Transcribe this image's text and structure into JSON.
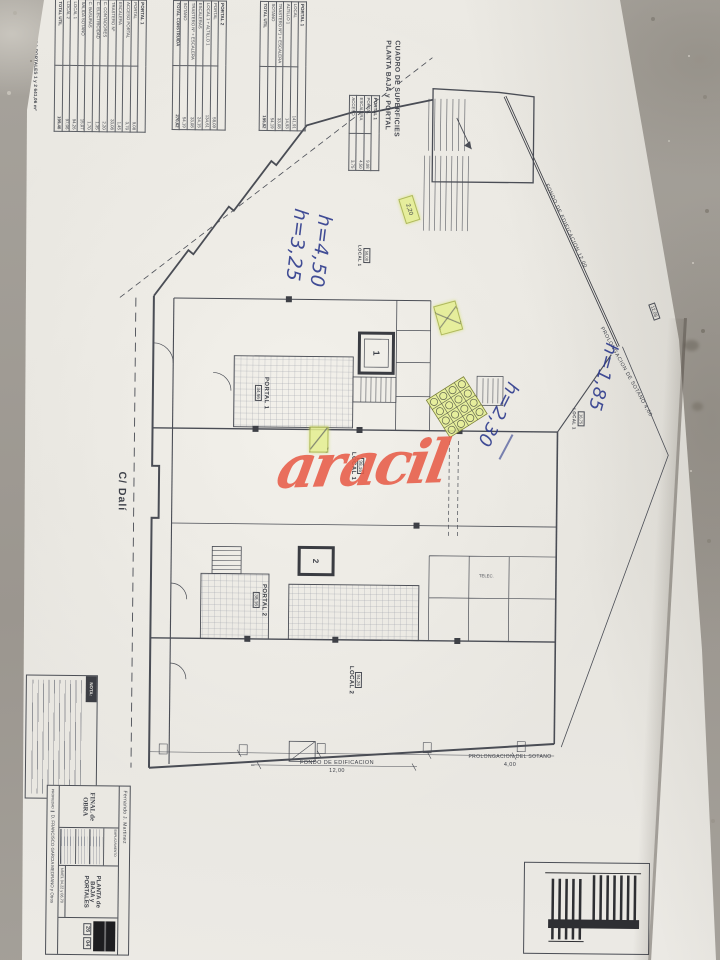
{
  "photo": {
    "street_label": "C/ Dalí",
    "watermark_text": "aracil",
    "watermark_color": "#e75c48",
    "ink_color": "#2c3a8c",
    "highlight_color": "#e4ee8f",
    "paper_color": "#eae8e2",
    "concrete_color": "#a39f98"
  },
  "surfaces_panel": {
    "title1": "CUADRO DE SUPERFICIES",
    "title2": "PLANTA BAJA y PORTAL",
    "mini": {
      "header": "PORTAL 1",
      "rows": [
        [
          "PORTAL",
          "9,08"
        ],
        [
          "ESCALERA",
          "4,50"
        ],
        [
          "ACCESO",
          "3,75"
        ]
      ]
    },
    "t1": {
      "header": "PORTAL 1",
      "rows": [
        [
          "LOCAL",
          "141,91"
        ],
        [
          "ALTILLO 1",
          "14,93"
        ],
        [
          "TRASTERO Nº1 + ESCALERA",
          "33,08"
        ],
        [
          "SOTANO",
          "54,19"
        ]
      ],
      "total_label": "TOTAL UTIL",
      "total": "199,82"
    },
    "t2": {
      "header": "PORTAL 2",
      "rows": [
        [
          "PORTAL",
          "58,09"
        ],
        [
          "LOCAL 1 + ALTILLO 1",
          "134,61"
        ],
        [
          "ESCALERAS",
          "24,15"
        ],
        [
          "TRASTERO Nº + ESCALERA",
          "33,08"
        ],
        [
          "SOTANO",
          "54,19"
        ]
      ],
      "total_label": "TOTAL CONSTRUIDA",
      "total": "270,62"
    },
    "t3": {
      "header": "PORTAL 1",
      "rows": [
        [
          "PORTAL",
          "9,08"
        ],
        [
          "ACCESO PORTAL",
          "3,70"
        ],
        [
          "ESCALERA",
          "1,45"
        ],
        [
          "TRASTERO Nº",
          "33,08"
        ],
        [
          "C. CONTADORES",
          "2,20"
        ],
        [
          "C. ELECTRICIDAD",
          "1,35"
        ],
        [
          "C. BASURAS",
          "1,70"
        ],
        [
          "SALIDA SOTANO",
          "15,07"
        ],
        [
          "LOCAL 1",
          "94,26"
        ],
        [
          "LOCAL 2",
          "97,06"
        ]
      ],
      "total_label": "TOTAL UTIL",
      "total": "199,40"
    },
    "totals_line": "TOTAL CONSTRUIDA PORTALES 1 y 2        641,06 m²"
  },
  "plan_labels": {
    "portal1": "PORTAL 1",
    "portal1_area": "34,56",
    "portal2": "PORTAL 2",
    "portal2_area": "38,16",
    "local1": "LOCAL 1",
    "local1_area": "98,16",
    "local1_upper": "LOCAL 1",
    "local1_upper_area": "58,08",
    "local1_notch": "LOCAL 1",
    "local1_notch_area": "16,75",
    "local2": "LOCAL 2",
    "local2_area": "94,26",
    "telec": "TELEC.",
    "lift1": "1",
    "lift2": "2",
    "dim220": "2,20",
    "dim1208": "12,08"
  },
  "dimensions": {
    "fondo_label": "FONDO DE EDIFICACION",
    "fondo_value": "12,00",
    "prolong_label": "PROLONGACION DEL SOTANO",
    "prolong_value": "4,00",
    "diag_fondo": "FONDO DE EDIFICACION    12,00",
    "diag_prolong": "PROLONGACION DE SOTANO    4,00"
  },
  "handwriting": {
    "h325": "h=3,25",
    "h450": "h=4,50",
    "h230": "h=2,30",
    "h185": "h=1,85"
  },
  "nota_label": "NOTA:",
  "title_block": {
    "architect": "Fernando J. Martinez",
    "doc_type": "FINAL de OBRA",
    "field1": "EMPLAZAMIENTO",
    "drawing_title": "PLANTA de BAJA y PORTALES",
    "nivel_label": "NIVEL",
    "nivel_value": "04,22 y 06,70",
    "propiedad_label": "PROPIEDAD",
    "owner": "D. FRANCISCO GARCIA MEDRANO y Otros",
    "sheet_no": "26",
    "sheet_no2": "04"
  }
}
